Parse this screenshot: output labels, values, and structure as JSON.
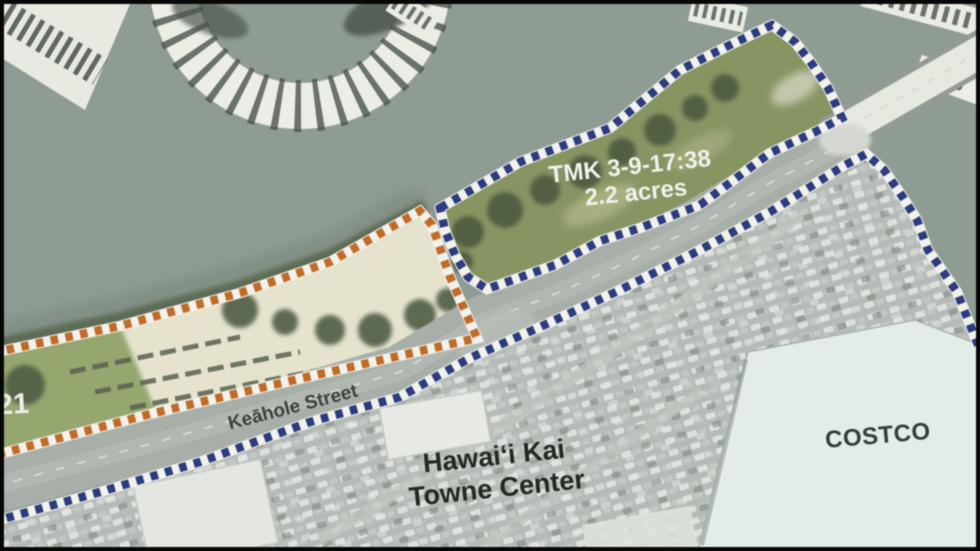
{
  "map": {
    "labels": {
      "tmk_line1": "TMK 3-9-17:38",
      "tmk_line2": "2.2 acres",
      "street": "Keāhole Street",
      "towne_center_line1": "Hawaiʻi Kai",
      "towne_center_line2": "Towne Center",
      "costco": "COSTCO",
      "left_parcel_partial": "21"
    },
    "colors": {
      "parcel_boundary_blue": "#2a3b84",
      "shoreline_boundary_orange": "#c96a20",
      "water": "#8f9d93",
      "parcel_grass": "#87965f",
      "sand": "#e7e5ce",
      "parking": "#b6bcb7",
      "costco_roof": "#e4efe9",
      "road": "#a9afa9",
      "label_light": "#f2f3ee",
      "label_dark": "#22261f"
    }
  }
}
